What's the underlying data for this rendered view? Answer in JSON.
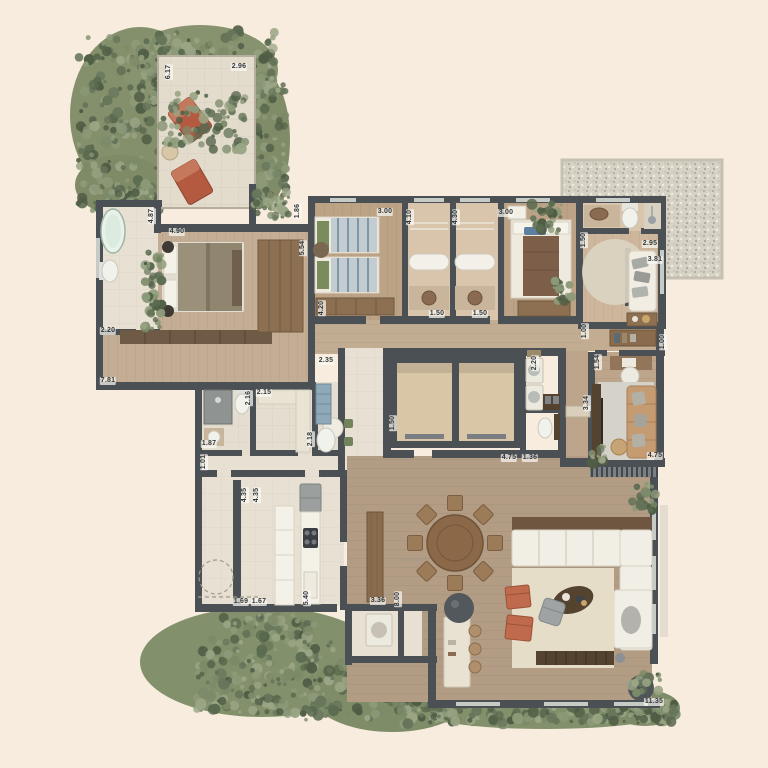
{
  "plan": {
    "type": "residential-floor-plan",
    "canvas": {
      "width": 768,
      "height": 768
    }
  },
  "palette": {
    "background": "#f7ecde",
    "wall": "#4b5055",
    "wood_bedroom": "#c3ad94",
    "wood_living": "#b29c84",
    "tile_light": "#e8e1d3",
    "tile_tan": "#d8c5ac",
    "patio": "#e3dccd",
    "gravel": "#d7d2c6",
    "terracotta": "#bf6a4c",
    "white_furniture": "#f1eee6",
    "wood_furniture": "#8d7051",
    "dark_wood": "#54432f",
    "elevator_shaft": "#d9c6a6",
    "blue_cabinet": "#8fa9b8",
    "rug_beige": "#e5ddc8",
    "rug_gray": "#d5d2ca",
    "foliage": [
      "#7b8a68",
      "#66755a",
      "#8c9a78",
      "#5a6a4f",
      "#9aa585",
      "#4f5d45"
    ]
  },
  "dimension_labels": [
    {
      "text": "6.17",
      "x": 169,
      "y": 72,
      "rot": -90
    },
    {
      "text": "2.96",
      "x": 239,
      "y": 67,
      "rot": 0
    },
    {
      "text": "4.87",
      "x": 152,
      "y": 216,
      "rot": -90
    },
    {
      "text": "4.90",
      "x": 177,
      "y": 232,
      "rot": 0
    },
    {
      "text": "1.86",
      "x": 298,
      "y": 211,
      "rot": -90
    },
    {
      "text": "5.54",
      "x": 303,
      "y": 248,
      "rot": -90
    },
    {
      "text": "2.20",
      "x": 108,
      "y": 331,
      "rot": 0
    },
    {
      "text": "7.81",
      "x": 108,
      "y": 381,
      "rot": 0
    },
    {
      "text": "4.20",
      "x": 322,
      "y": 308,
      "rot": -90
    },
    {
      "text": "3.00",
      "x": 385,
      "y": 212,
      "rot": 0
    },
    {
      "text": "4.10",
      "x": 410,
      "y": 217,
      "rot": -90
    },
    {
      "text": "4.30",
      "x": 456,
      "y": 217,
      "rot": -90
    },
    {
      "text": "3.00",
      "x": 506,
      "y": 213,
      "rot": 0
    },
    {
      "text": "1.50",
      "x": 437,
      "y": 314,
      "rot": 0
    },
    {
      "text": "1.50",
      "x": 480,
      "y": 314,
      "rot": 0
    },
    {
      "text": "1.50",
      "x": 584,
      "y": 240,
      "rot": -90
    },
    {
      "text": "2.95",
      "x": 650,
      "y": 244,
      "rot": 0
    },
    {
      "text": "3.81",
      "x": 655,
      "y": 260,
      "rot": 0
    },
    {
      "text": "2.35",
      "x": 326,
      "y": 361,
      "rot": 0
    },
    {
      "text": "2.15",
      "x": 264,
      "y": 393,
      "rot": 0
    },
    {
      "text": "2.16",
      "x": 249,
      "y": 398,
      "rot": -90
    },
    {
      "text": "1.87",
      "x": 209,
      "y": 444,
      "rot": 0
    },
    {
      "text": "1.01",
      "x": 204,
      "y": 462,
      "rot": -90
    },
    {
      "text": "2.18",
      "x": 311,
      "y": 439,
      "rot": -90
    },
    {
      "text": "1.50",
      "x": 393,
      "y": 423,
      "rot": -90
    },
    {
      "text": "2.20",
      "x": 535,
      "y": 363,
      "rot": -90
    },
    {
      "text": "4.75",
      "x": 509,
      "y": 458,
      "rot": 0
    },
    {
      "text": "1.36",
      "x": 530,
      "y": 458,
      "rot": 0
    },
    {
      "text": "1.00",
      "x": 585,
      "y": 331,
      "rot": -90
    },
    {
      "text": "1.54",
      "x": 598,
      "y": 362,
      "rot": -90
    },
    {
      "text": "3.34",
      "x": 587,
      "y": 403,
      "rot": -90
    },
    {
      "text": "1.00",
      "x": 663,
      "y": 342,
      "rot": -90
    },
    {
      "text": "4.75",
      "x": 655,
      "y": 456,
      "rot": 0
    },
    {
      "text": "4.35",
      "x": 245,
      "y": 495,
      "rot": -90
    },
    {
      "text": "4.35",
      "x": 257,
      "y": 495,
      "rot": -90
    },
    {
      "text": "1.69",
      "x": 241,
      "y": 602,
      "rot": 0
    },
    {
      "text": "1.67",
      "x": 259,
      "y": 602,
      "rot": 0
    },
    {
      "text": "5.40",
      "x": 307,
      "y": 598,
      "rot": -90
    },
    {
      "text": "3.36",
      "x": 378,
      "y": 601,
      "rot": 0
    },
    {
      "text": "8.00",
      "x": 398,
      "y": 599,
      "rot": -90
    },
    {
      "text": "11.35",
      "x": 654,
      "y": 702,
      "rot": 0
    }
  ]
}
